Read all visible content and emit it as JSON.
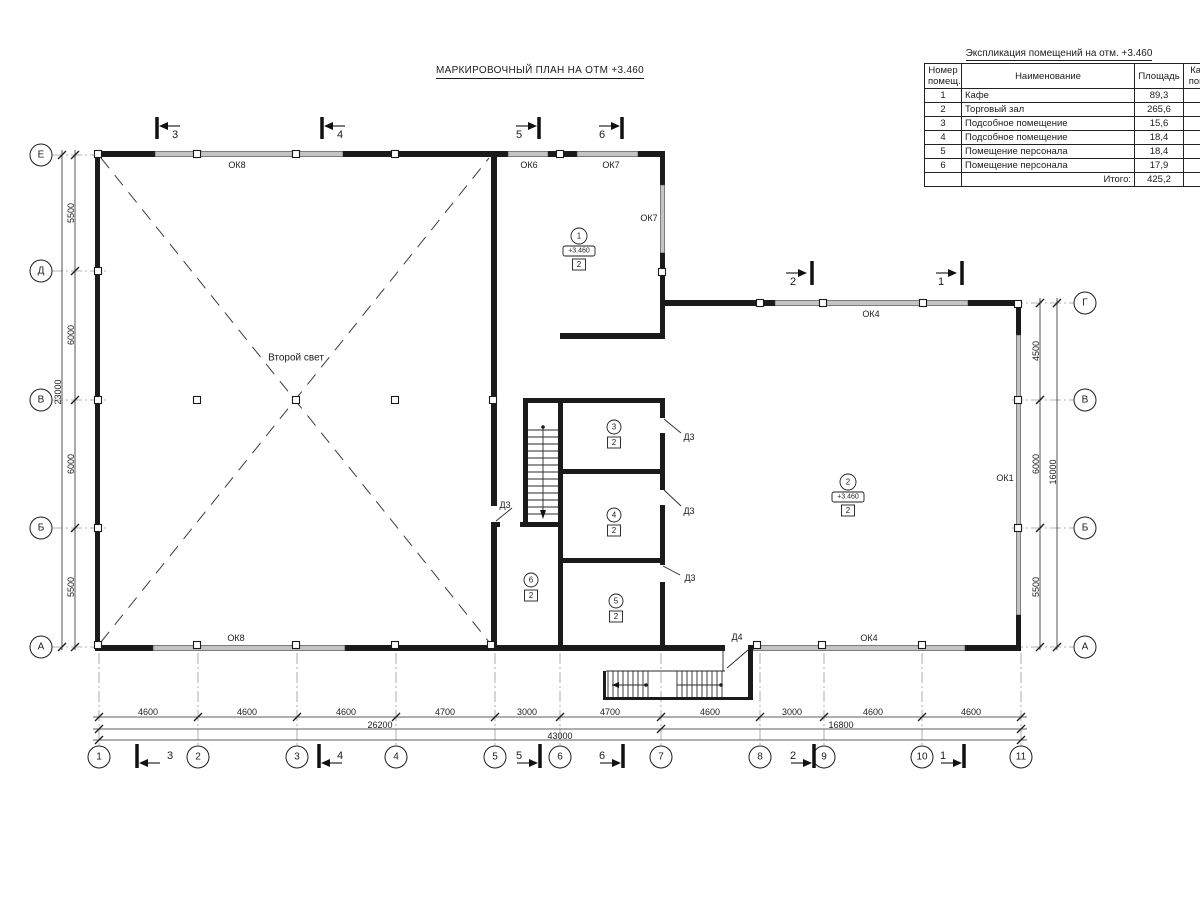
{
  "page_title": "МАРКИРОВОЧНЫЙ ПЛАН НА ОТМ +3.460",
  "explication": {
    "title": "Экспликация помещений на отм. +3.460",
    "headers": {
      "num": "Номер помещ.",
      "name": "Наименование",
      "area": "Площадь",
      "cat": "Кат. пом."
    },
    "rows": [
      {
        "num": "1",
        "name": "Кафе",
        "area": "89,3",
        "cat": ""
      },
      {
        "num": "2",
        "name": "Торговый зал",
        "area": "265,6",
        "cat": ""
      },
      {
        "num": "3",
        "name": "Подсобное помещение",
        "area": "15,6",
        "cat": ""
      },
      {
        "num": "4",
        "name": "Подсобное помещение",
        "area": "18,4",
        "cat": ""
      },
      {
        "num": "5",
        "name": "Помещение персонала",
        "area": "18,4",
        "cat": ""
      },
      {
        "num": "6",
        "name": "Помещение персонала",
        "area": "17,9",
        "cat": ""
      }
    ],
    "total_label": "Итого:",
    "total_value": "425,2"
  },
  "axes": {
    "left": [
      "Е",
      "Д",
      "В",
      "Б",
      "А"
    ],
    "right": [
      "Г",
      "В",
      "Б",
      "А"
    ],
    "bottom": [
      "1",
      "2",
      "3",
      "4",
      "5",
      "6",
      "7",
      "8",
      "9",
      "10",
      "11"
    ]
  },
  "dims": {
    "left": [
      "5500",
      "6000",
      "6000",
      "5500"
    ],
    "left_total": "23000",
    "right": [
      "4500",
      "6000",
      "5500"
    ],
    "right_total": "16000",
    "bottom": [
      "4600",
      "4600",
      "4600",
      "4700",
      "3000",
      "4700",
      "4600",
      "3000",
      "4600",
      "4600"
    ],
    "bottom_sub_left": "26200",
    "bottom_sub_right": "16800",
    "bottom_total": "43000"
  },
  "sections": {
    "top": [
      "3",
      "4",
      "5",
      "6"
    ],
    "right": [
      "2",
      "1"
    ],
    "bottom": [
      "3",
      "4",
      "5",
      "6",
      "2",
      "1"
    ]
  },
  "windows": {
    "ok8": "ОК8",
    "ok6": "ОК6",
    "ok7": "ОК7",
    "ok4": "ОК4",
    "ok1": "ОК1"
  },
  "doors": {
    "d3": "Д3",
    "d4": "Д4"
  },
  "rooms": {
    "r1": {
      "num": "1",
      "elev": "+3.460",
      "cat": "2"
    },
    "r2": {
      "num": "2",
      "elev": "+3.460",
      "cat": "2"
    },
    "r3": {
      "num": "3",
      "cat": "2"
    },
    "r4": {
      "num": "4",
      "cat": "2"
    },
    "r5": {
      "num": "5",
      "cat": "2"
    },
    "r6": {
      "num": "6",
      "cat": "2"
    }
  },
  "annotations": {
    "second_light": "Второй свет"
  },
  "colors": {
    "wall": "#1b1b1b",
    "window": "#c4c4c4",
    "axis_line": "#9a9a9a",
    "ink": "#1c1c1c"
  }
}
